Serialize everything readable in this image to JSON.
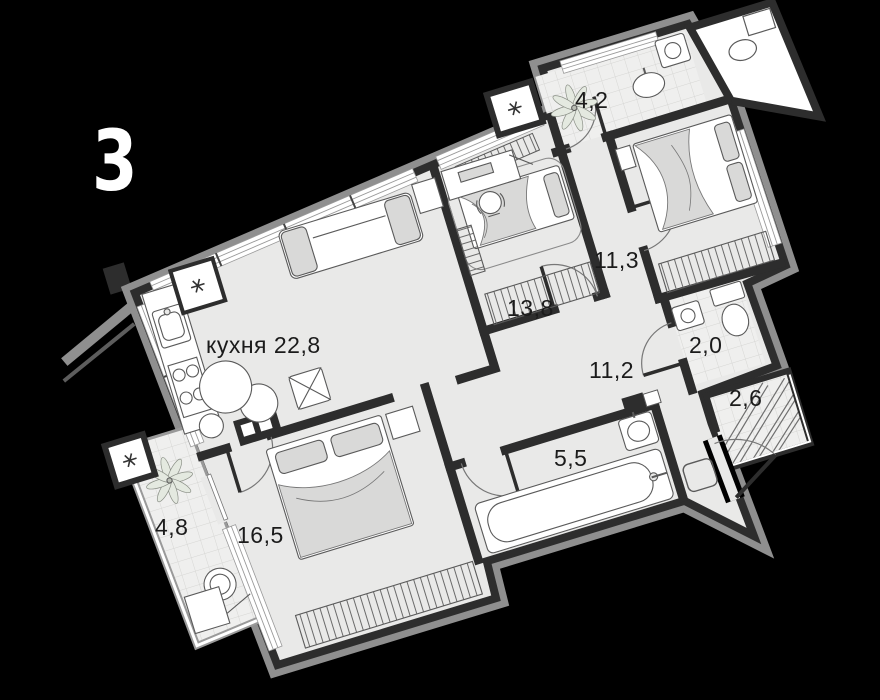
{
  "plan": {
    "number": "3"
  },
  "rooms": [
    {
      "id": "kitchen-living",
      "label": "кухня 22,8"
    },
    {
      "id": "room-13-8",
      "label": "13,8"
    },
    {
      "id": "bedroom-11-3",
      "label": "11,3"
    },
    {
      "id": "bathroom-4-2",
      "label": "4,2"
    },
    {
      "id": "wc-2-0",
      "label": "2,0"
    },
    {
      "id": "loggia-2-6",
      "label": "2,6"
    },
    {
      "id": "hallway-11-2",
      "label": "11,2"
    },
    {
      "id": "bathroom-5-5",
      "label": "5,5"
    },
    {
      "id": "bedroom-16-5",
      "label": "16,5"
    },
    {
      "id": "loggia-4-8",
      "label": "4,8"
    }
  ],
  "colors": {
    "background": "#000000",
    "floor": "#e9e9e8",
    "wall": "#2d2d2d",
    "outer_rim": "#8f8f8f",
    "tile_line": "#d6d6d4",
    "furniture_line": "#5a5a5a",
    "soft_fill": "#d9d9d8",
    "label_text": "#1b1b1b",
    "plan_number_text": "#ffffff"
  }
}
